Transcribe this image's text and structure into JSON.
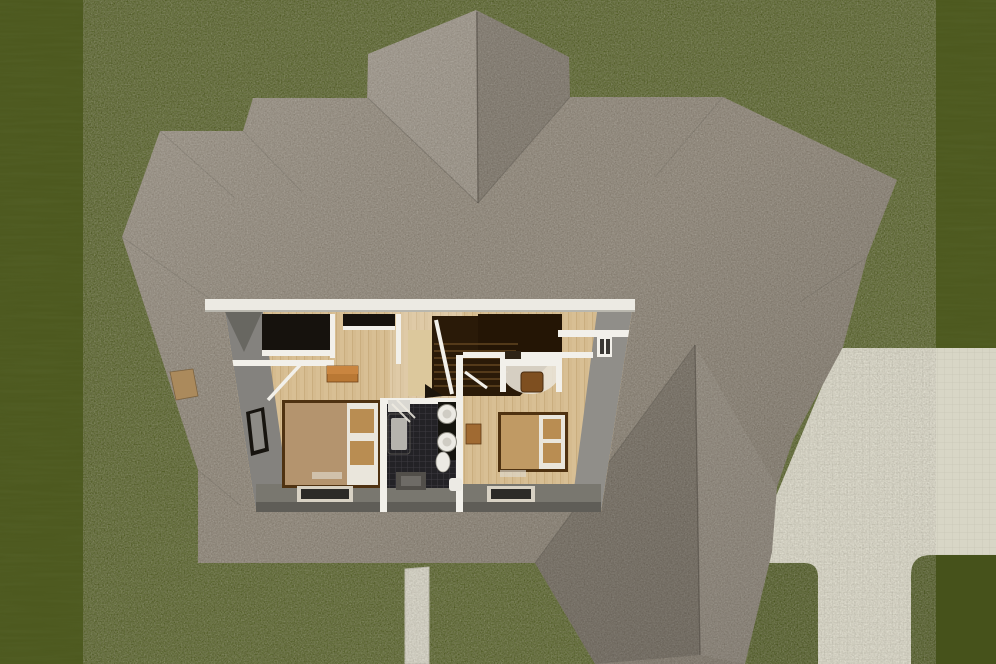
{
  "scene": {
    "label": "Overhead 3D dollhouse view of a house upper floor with yard and patio",
    "rooms": [
      "left-bedroom",
      "stair-hall",
      "bathroom",
      "right-bedroom"
    ],
    "exterior": [
      "grass-yard",
      "shingle-roof",
      "tile-patio",
      "walkway",
      "chimney"
    ]
  },
  "palette": {
    "grass": "#4d591f",
    "grassDark": "#46521b",
    "patio": "#d8d6c6",
    "patioLine": "#c2c0b0",
    "walkway": "#d3d1c3",
    "roofBase": "#8c8375",
    "roofRidge": "#524d46",
    "trim": "#eceae3",
    "wallWhite": "#f2f0ea",
    "wallGrayL": "#84827e",
    "wallGrayR": "#908e89",
    "wallGrayBand": "#79776f",
    "wallGrayBandDark": "#5f5d57",
    "woodFloor": "#d8bf94",
    "woodPlankLine": "#c6a877",
    "woodLanding": "#dcc89c",
    "closetDark": "#16120d",
    "stairDark": "#2a1a08",
    "stairDarkUpper": "#241505",
    "tread": "#6e4e26",
    "dresser": "#b97834",
    "dresserTop": "#c9853f",
    "bedFrame": "#4f3211",
    "bedBlanketLeft": "#b4946e",
    "bedBlanketRight": "#c09a64",
    "pillowWhite": "#eae6dc",
    "pillowTan": "#b98d52",
    "rugDark": "#2c2b28",
    "rugBorder": "#d8d2c4",
    "bathFloor": "#232226",
    "bathGridLine": "#3c3b40",
    "fixture": "#eceae4",
    "tub": "#c7c5bf",
    "tubInner": "#b5b3ad",
    "counterDark": "#15140f",
    "matDark": "#524f4a",
    "matInner": "#6e6b66",
    "chimney": "#ab8a5c",
    "chair": "#7e4f20",
    "sideTable": "#a06a32",
    "deskArc": "#e9e3d7",
    "ventLight": "#ded9cc"
  }
}
